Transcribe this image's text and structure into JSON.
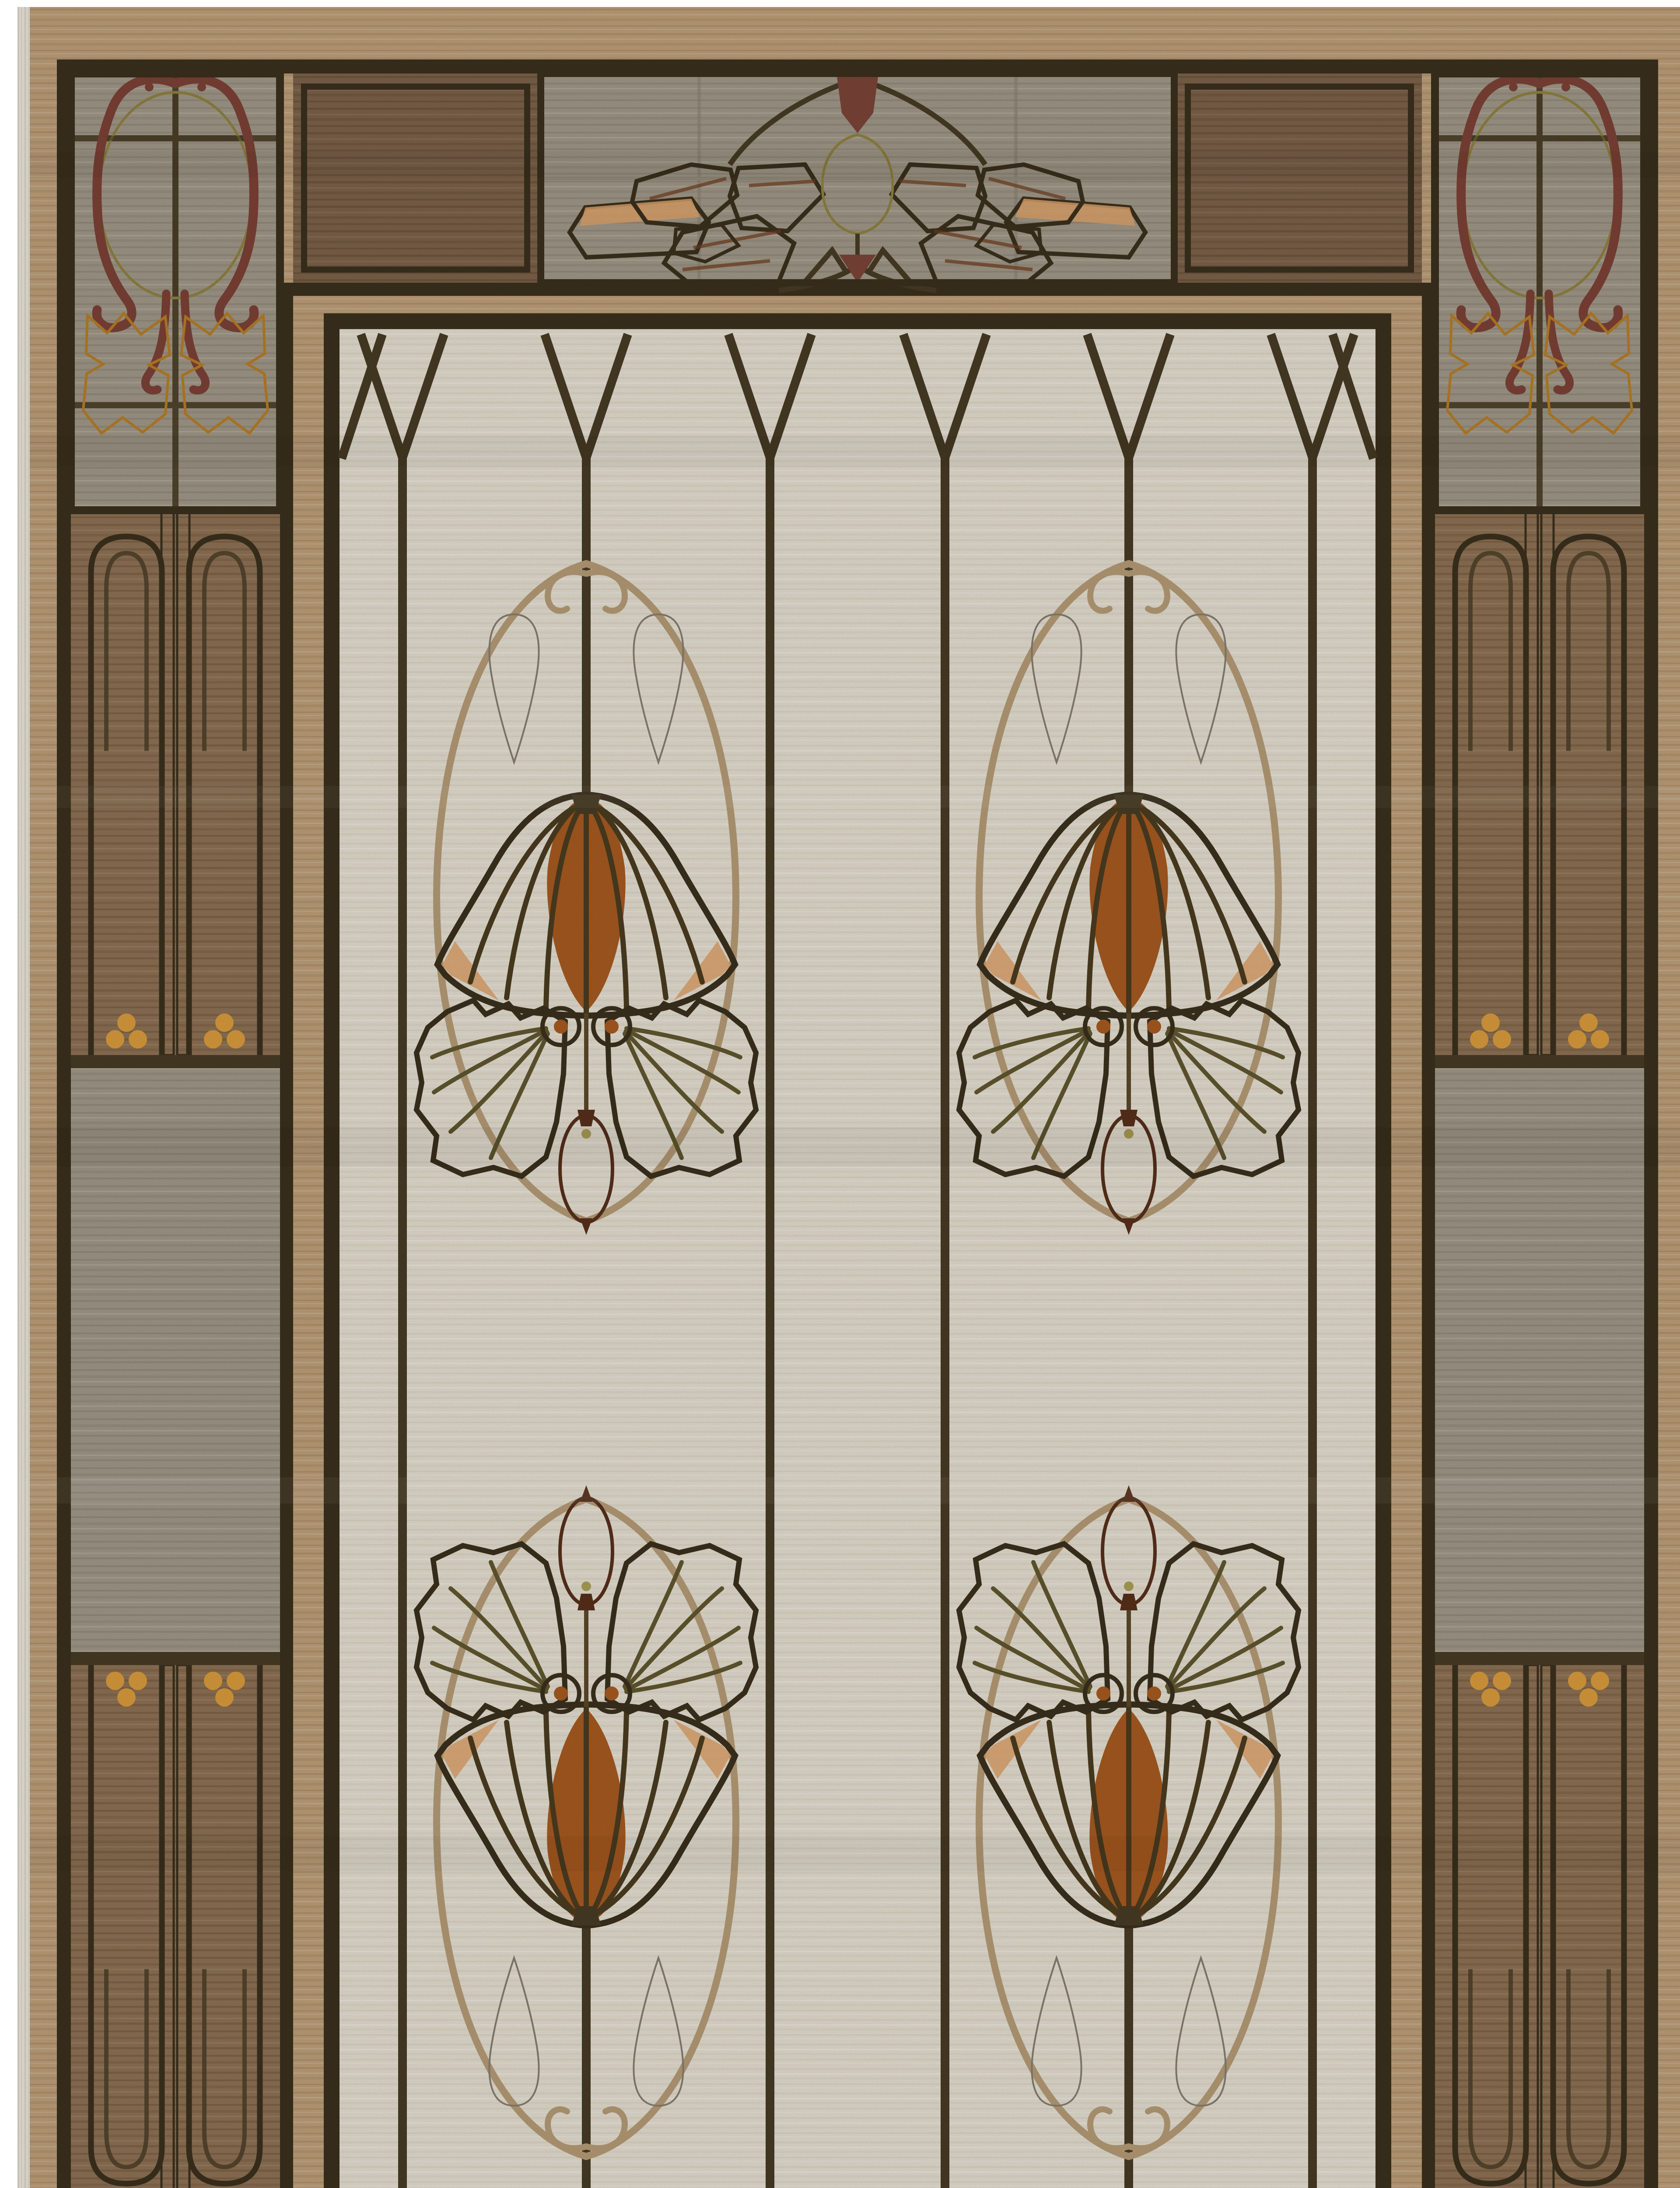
{
  "meta": {
    "title": "Arts and Crafts stained-glass style area rug",
    "alt": "Portrait-orientation Arts and Crafts wool rug: ivory central field divided into lancet-window panels by dark mullion lines, two mirrored columns of orange bell-flower clusters with olive leaves, gray teardrop buds and hanging rust seed pods; taupe-gray and brown border band with olive lantern medallions in rust scroll frames at the corners, gold trefoil and twin-stripe arch panels on the sides, and rust oak-leaf clusters around an olive bud on the top and bottom panels; tan outer margin with pale fringe edges."
  },
  "palette": {
    "ivory": "#e4ded0",
    "ivoryS": "#c6bda8",
    "tan": "#bd9f7a",
    "tanS": "#9d7e57",
    "brown": "#8d7154",
    "brownS": "#6d5436",
    "dbrown": "#7c624a",
    "dbrownS": "#5f4a31",
    "gray": "#a09888",
    "grayS": "#867d6e",
    "olive": "#ac9e55",
    "oliveD": "#8e8140",
    "gold": "#d99b3c",
    "goldD": "#b67d25",
    "scroll": "#7c4136",
    "orange": "#c77c3d",
    "orangeD": "#a65a20",
    "orangeL": "#dda26a",
    "rustleaf": "#9b5129",
    "rustleafD": "#6f3a1c",
    "green": "#9c9456",
    "greenD": "#60572f",
    "teardrop": "#9d9588",
    "teardropD": "#857d70",
    "pod": "#8e4728",
    "podD": "#57301b",
    "cart": "#b59b76",
    "maroon": "#7b4437",
    "line": "#473b24",
    "outline": "#3b301d",
    "vein": "#4a3c20",
    "fringe": "#eae6da"
  },
  "motifs": {
    "style": "Arts and Crafts / Mission stained-glass",
    "field": {
      "background": "ivory woodgrain",
      "window_columns": 7,
      "mullion_arches": "Y-split pointed lancet arches at top and bottom",
      "flower_clusters": 4,
      "cluster_elements": [
        "tan pointed-oval cartouche",
        "two gray teardrop buds",
        "orange bell flower with dark veins",
        "two olive green leaves with orange discs",
        "hanging rust seed pod"
      ]
    },
    "border": {
      "corner_motif": "olive lantern medallion in rust scroll frame with gold leaf blocks",
      "corner_count": 4,
      "side_motif": "twin gold stripes between arched gray windows with gold trefoil finials",
      "top_bottom_motif": "rust oak-leaf sprays flanking an olive seed bud on gray panel",
      "rings": [
        "dark outer rule",
        "dark inner rule",
        "tan spacer",
        "dark field frame"
      ]
    },
    "edges": {
      "fringe_sides": [
        "left",
        "right",
        "bottom"
      ],
      "margin": "tan woodgrain"
    }
  }
}
